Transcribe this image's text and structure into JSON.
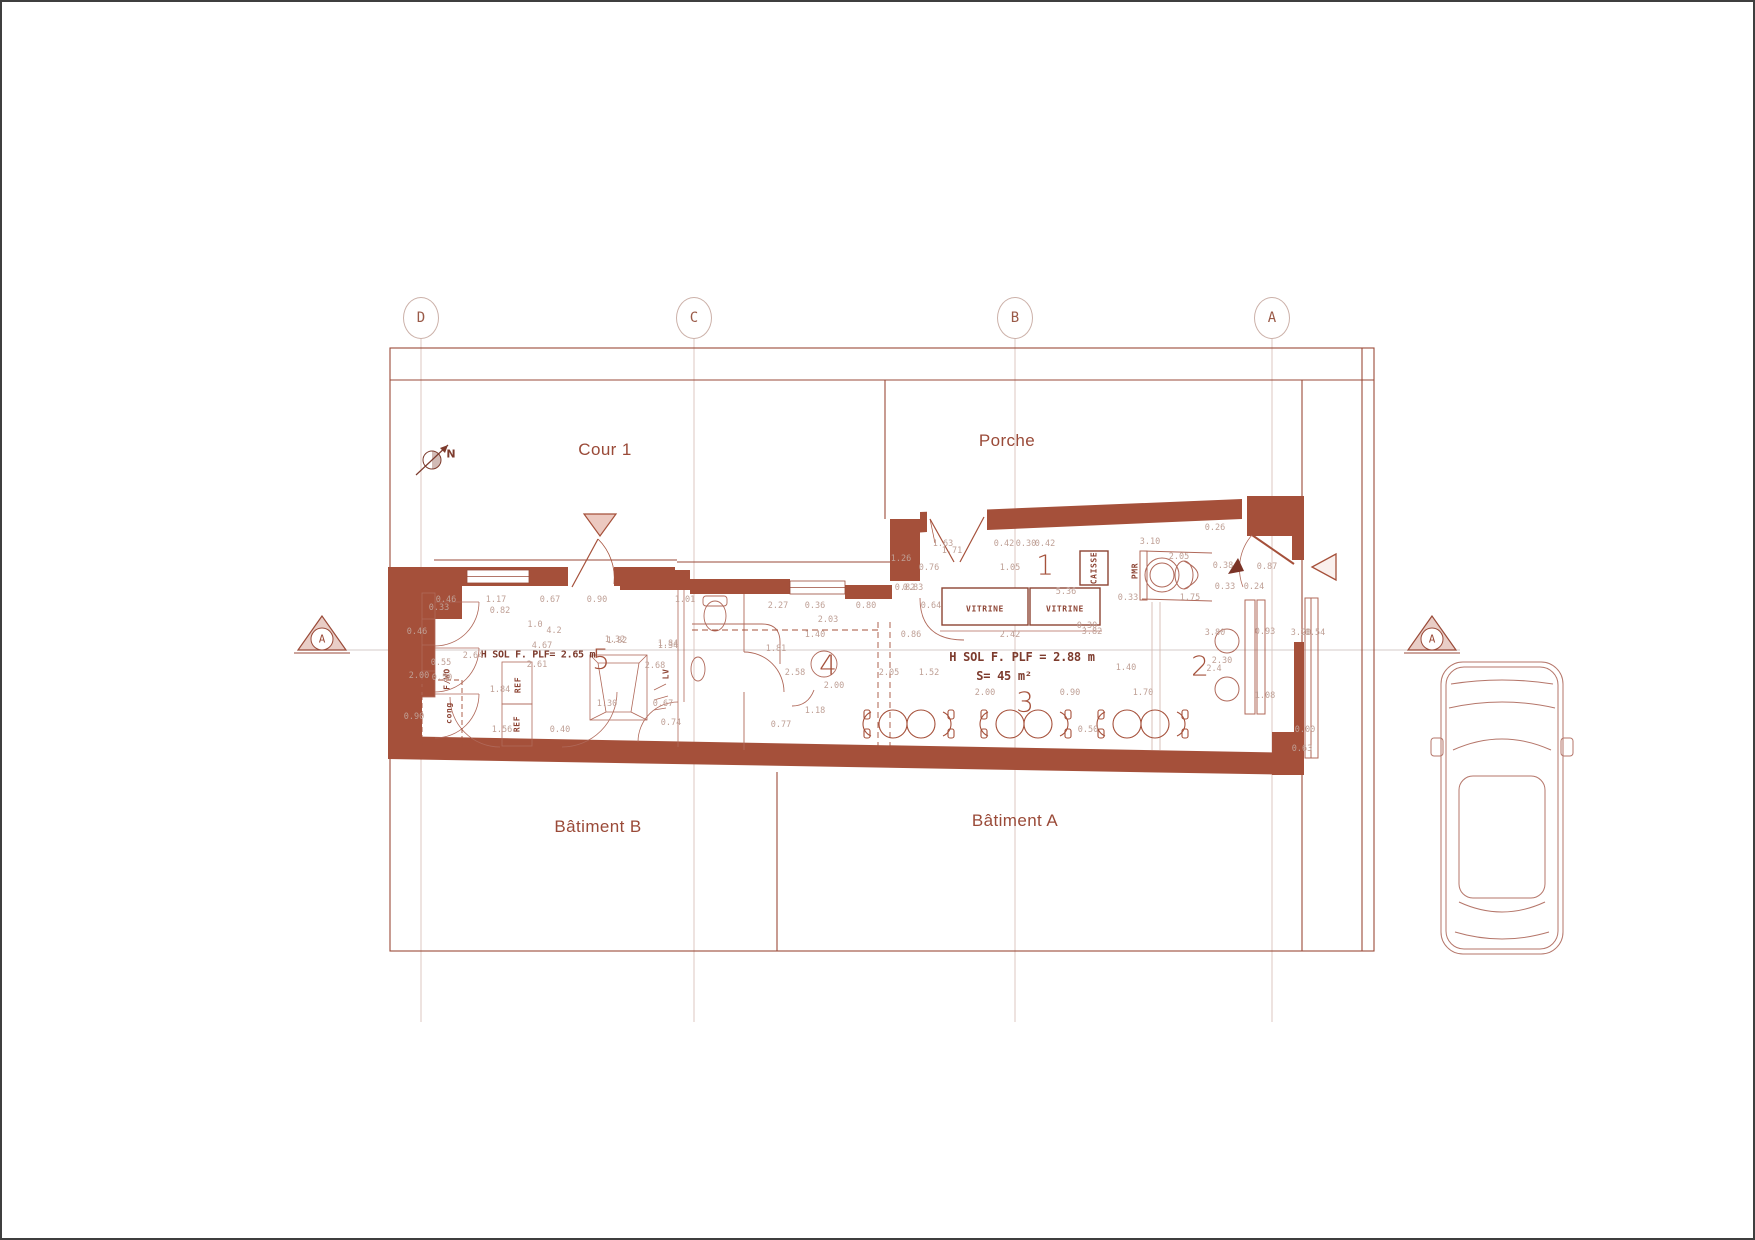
{
  "drawing": {
    "type": "floor-plan",
    "section_label": "A",
    "north_label": "N"
  },
  "colors": {
    "wall": "#a5503a",
    "line": "#9a4a38",
    "light_line": "#d9c0b9",
    "interior_line": "#b0695a",
    "dim_text": "#bfa096",
    "label_text": "#9a4a38"
  },
  "grid": {
    "markers": [
      {
        "label": "D",
        "x": 419,
        "y": 316
      },
      {
        "label": "C",
        "x": 692,
        "y": 316
      },
      {
        "label": "B",
        "x": 1013,
        "y": 316
      },
      {
        "label": "A",
        "x": 1270,
        "y": 316
      }
    ]
  },
  "areas": {
    "cour": "Cour 1",
    "porche": "Porche",
    "batiment_b": "Bâtiment B",
    "batiment_a": "Bâtiment A"
  },
  "rooms": [
    {
      "n": "1",
      "x": 1043,
      "y": 563
    },
    {
      "n": "2",
      "x": 1198,
      "y": 664
    },
    {
      "n": "3",
      "x": 1023,
      "y": 700
    },
    {
      "n": "4",
      "x": 826,
      "y": 663
    },
    {
      "n": "5",
      "x": 599,
      "y": 657
    }
  ],
  "notes": [
    {
      "text": "H SOL F. PLF= 2.65 m",
      "x": 536,
      "y": 653,
      "big": false
    },
    {
      "text": "H SOL F. PLF = 2.88 m",
      "x": 1020,
      "y": 655,
      "big": true
    },
    {
      "text": "S= 45 m²",
      "x": 1002,
      "y": 674,
      "big": true
    }
  ],
  "fixtures": [
    {
      "text": "VITRINE",
      "x": 983,
      "y": 607,
      "rot": false
    },
    {
      "text": "VITRINE",
      "x": 1063,
      "y": 607,
      "rot": false
    },
    {
      "text": "CAISSE",
      "x": 1092,
      "y": 566,
      "rot": true
    },
    {
      "text": "PMR",
      "x": 1133,
      "y": 569,
      "rot": true
    },
    {
      "text": "F/WO",
      "x": 445,
      "y": 677,
      "rot": true
    },
    {
      "text": "REF",
      "x": 516,
      "y": 683,
      "rot": true
    },
    {
      "text": "REF",
      "x": 515,
      "y": 722,
      "rot": true
    },
    {
      "text": "cong",
      "x": 447,
      "y": 711,
      "rot": true
    },
    {
      "text": "LV",
      "x": 664,
      "y": 672,
      "rot": true
    }
  ],
  "dimensions": [
    {
      "t": "0.46",
      "x": 444,
      "y": 598
    },
    {
      "t": "1.17",
      "x": 494,
      "y": 598
    },
    {
      "t": "0.67",
      "x": 548,
      "y": 598
    },
    {
      "t": "0.90",
      "x": 595,
      "y": 598
    },
    {
      "t": "1.01",
      "x": 683,
      "y": 598
    },
    {
      "t": "0.33",
      "x": 437,
      "y": 606
    },
    {
      "t": "0.82",
      "x": 498,
      "y": 609
    },
    {
      "t": "1.0",
      "x": 533,
      "y": 623
    },
    {
      "t": "4.2",
      "x": 552,
      "y": 629
    },
    {
      "t": "0.46",
      "x": 415,
      "y": 630
    },
    {
      "t": "4.67",
      "x": 540,
      "y": 644
    },
    {
      "t": "2.64",
      "x": 471,
      "y": 654
    },
    {
      "t": "0.55",
      "x": 439,
      "y": 661
    },
    {
      "t": "2.61",
      "x": 535,
      "y": 663
    },
    {
      "t": "1.82",
      "x": 615,
      "y": 639
    },
    {
      "t": "1.34",
      "x": 666,
      "y": 644
    },
    {
      "t": "2.68",
      "x": 653,
      "y": 664
    },
    {
      "t": "2.00",
      "x": 417,
      "y": 674
    },
    {
      "t": "0.50",
      "x": 440,
      "y": 676
    },
    {
      "t": "1.84",
      "x": 498,
      "y": 688
    },
    {
      "t": "0.90",
      "x": 412,
      "y": 715
    },
    {
      "t": "1.56",
      "x": 500,
      "y": 728
    },
    {
      "t": "0.40",
      "x": 558,
      "y": 728
    },
    {
      "t": "1.30",
      "x": 605,
      "y": 702
    },
    {
      "t": "0.67",
      "x": 661,
      "y": 702
    },
    {
      "t": "0.74",
      "x": 669,
      "y": 721
    },
    {
      "t": "1.32",
      "x": 613,
      "y": 638
    },
    {
      "t": "1.84",
      "x": 666,
      "y": 642
    },
    {
      "t": "2.27",
      "x": 776,
      "y": 604
    },
    {
      "t": "0.36",
      "x": 813,
      "y": 604
    },
    {
      "t": "0.80",
      "x": 864,
      "y": 604
    },
    {
      "t": "2.03",
      "x": 826,
      "y": 618
    },
    {
      "t": "1.40",
      "x": 813,
      "y": 633
    },
    {
      "t": "1.81",
      "x": 774,
      "y": 647
    },
    {
      "t": "2.58",
      "x": 793,
      "y": 671
    },
    {
      "t": "2.00",
      "x": 832,
      "y": 684
    },
    {
      "t": "2.05",
      "x": 887,
      "y": 671
    },
    {
      "t": "1.52",
      "x": 927,
      "y": 671
    },
    {
      "t": "1.18",
      "x": 813,
      "y": 709
    },
    {
      "t": "0.77",
      "x": 779,
      "y": 723
    },
    {
      "t": "1.63",
      "x": 941,
      "y": 542
    },
    {
      "t": "1.71",
      "x": 950,
      "y": 549
    },
    {
      "t": "0.42",
      "x": 1002,
      "y": 542
    },
    {
      "t": "0.30",
      "x": 1024,
      "y": 542
    },
    {
      "t": "0.42",
      "x": 1043,
      "y": 542
    },
    {
      "t": "1.26",
      "x": 899,
      "y": 557
    },
    {
      "t": "0.76",
      "x": 927,
      "y": 566
    },
    {
      "t": "1.05",
      "x": 1008,
      "y": 566
    },
    {
      "t": "0.83",
      "x": 911,
      "y": 586
    },
    {
      "t": "0.64",
      "x": 929,
      "y": 604
    },
    {
      "t": "5.36",
      "x": 1064,
      "y": 590
    },
    {
      "t": "0.82",
      "x": 903,
      "y": 586
    },
    {
      "t": "0.86",
      "x": 909,
      "y": 633
    },
    {
      "t": "2.42",
      "x": 1008,
      "y": 633
    },
    {
      "t": "3.82",
      "x": 1090,
      "y": 630
    },
    {
      "t": "2.00",
      "x": 983,
      "y": 691
    },
    {
      "t": "0.90",
      "x": 1068,
      "y": 691
    },
    {
      "t": "0.30",
      "x": 1085,
      "y": 624
    },
    {
      "t": "0.50",
      "x": 1086,
      "y": 728
    },
    {
      "t": "3.10",
      "x": 1148,
      "y": 540
    },
    {
      "t": "2.05",
      "x": 1177,
      "y": 555
    },
    {
      "t": "0.26",
      "x": 1213,
      "y": 526
    },
    {
      "t": "0.38",
      "x": 1221,
      "y": 564
    },
    {
      "t": "0.33",
      "x": 1223,
      "y": 585
    },
    {
      "t": "0.24",
      "x": 1252,
      "y": 585
    },
    {
      "t": "0.33",
      "x": 1126,
      "y": 596
    },
    {
      "t": "1.75",
      "x": 1188,
      "y": 596
    },
    {
      "t": "0.87",
      "x": 1265,
      "y": 565
    },
    {
      "t": "3.80",
      "x": 1213,
      "y": 631
    },
    {
      "t": "2.30",
      "x": 1220,
      "y": 659
    },
    {
      "t": "2.4",
      "x": 1212,
      "y": 667
    },
    {
      "t": "0.93",
      "x": 1263,
      "y": 630
    },
    {
      "t": "3.20",
      "x": 1299,
      "y": 631
    },
    {
      "t": "0.54",
      "x": 1313,
      "y": 631
    },
    {
      "t": "1.40",
      "x": 1124,
      "y": 666
    },
    {
      "t": "1.70",
      "x": 1141,
      "y": 691
    },
    {
      "t": "1.08",
      "x": 1263,
      "y": 694
    },
    {
      "t": "0.00",
      "x": 1303,
      "y": 728
    },
    {
      "t": "0.63",
      "x": 1300,
      "y": 747
    }
  ]
}
